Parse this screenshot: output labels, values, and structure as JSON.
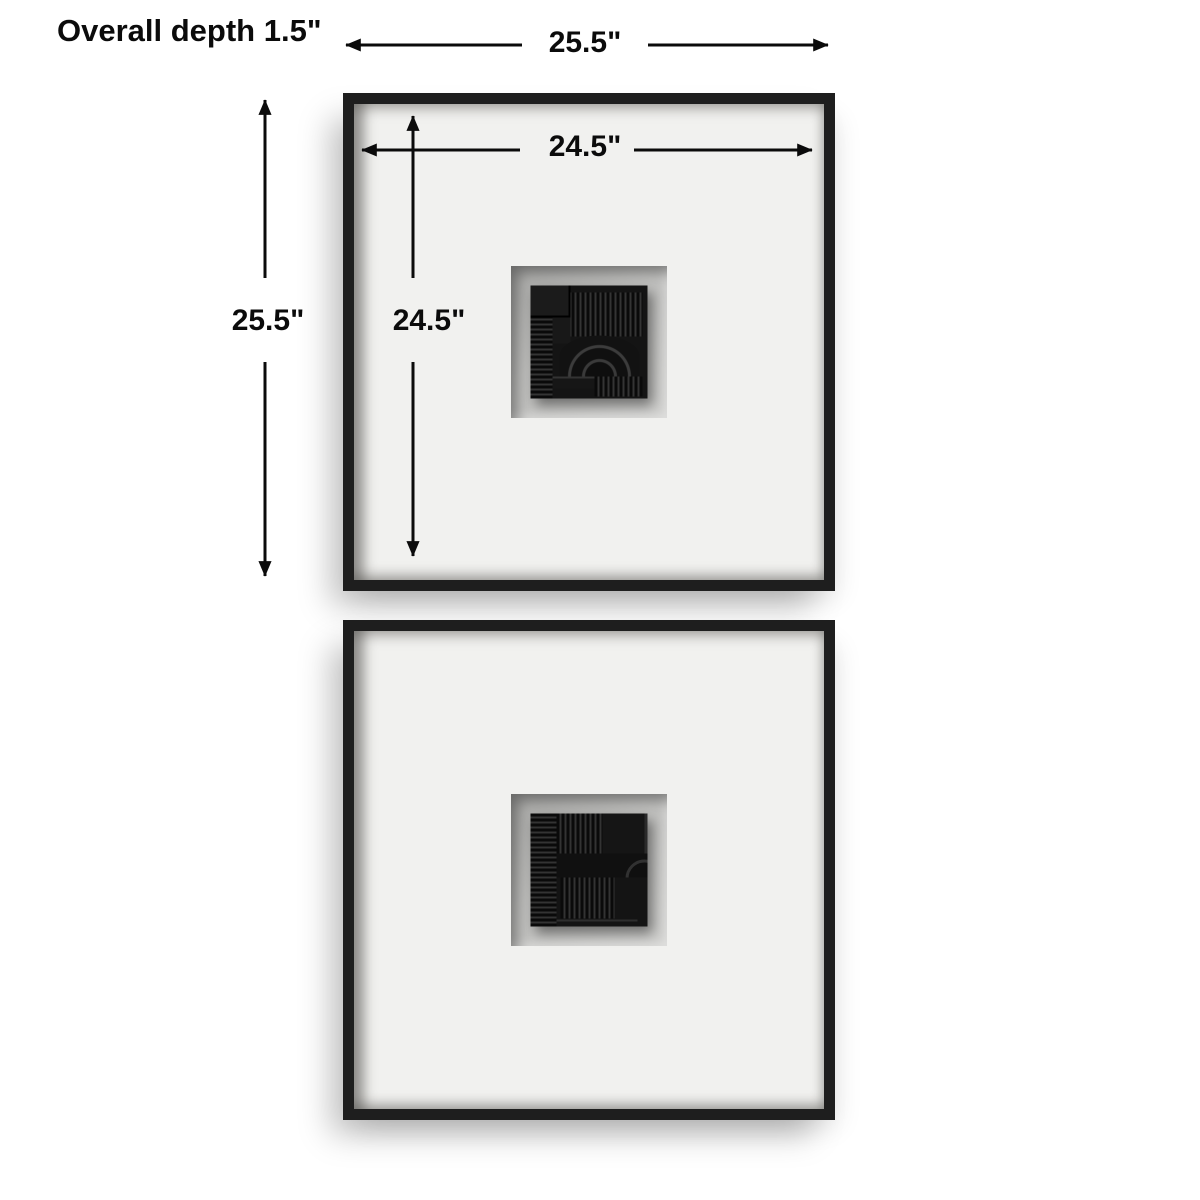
{
  "annotations": {
    "depth_label": "Overall depth 1.5\"",
    "outer_width_label": "25.5\"",
    "outer_height_label": "25.5\"",
    "inner_width_label": "24.5\"",
    "inner_height_label": "24.5\""
  },
  "product": {
    "items": [
      {
        "position": "top",
        "description": "black square shadowbox frame, white mat, black abstract relief tile with ribbed lines and arch"
      },
      {
        "position": "bottom",
        "description": "black square shadowbox frame, white mat, black abstract relief tile with ribbed lines and edge circle"
      }
    ]
  },
  "colors": {
    "background": "#ffffff",
    "frame": "#1e1e1e",
    "mat": "#f1f1ef",
    "recess": "#c1c1bf",
    "sculpture": "#141414",
    "dimension_lines": "#0b0b0b"
  },
  "icons": {
    "arrowheads": "solid black triangle arrow ends on all dimension lines"
  }
}
